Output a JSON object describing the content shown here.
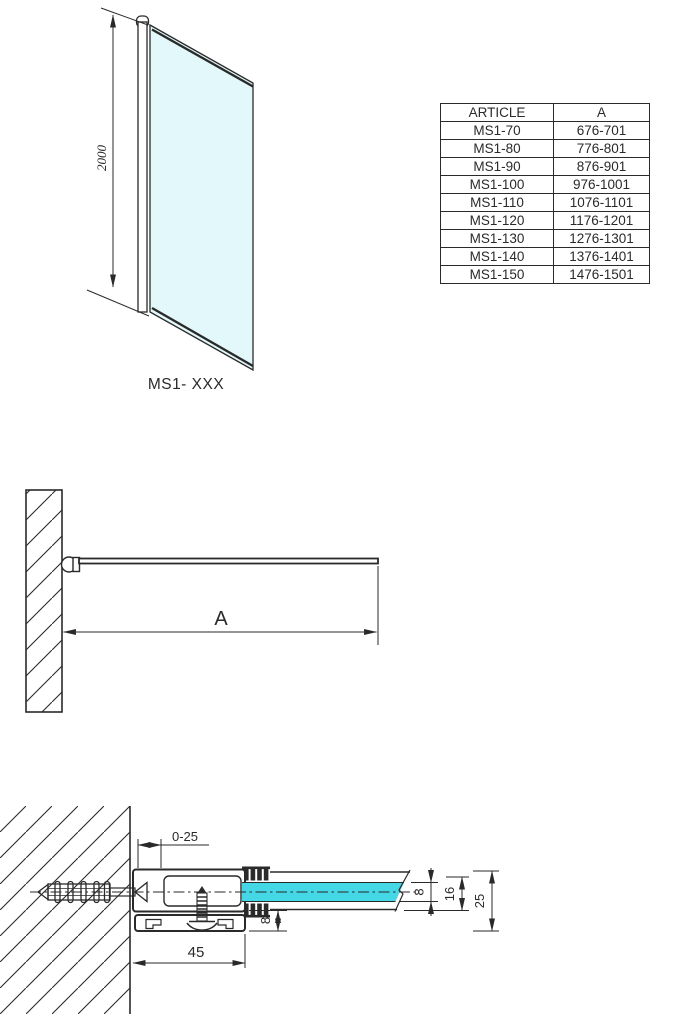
{
  "colors": {
    "line": "#2a2a2a",
    "glass_light": "#e2f8fa",
    "glass_bright": "#44d7e5",
    "background": "#ffffff"
  },
  "front_view": {
    "height_dimension": "2000",
    "model_label": "MS1- XXX"
  },
  "plan_view": {
    "width_dimension": "A"
  },
  "detail_view": {
    "wall_offset_dimension": "0-25",
    "profile_width_dimension": "45",
    "glass_thickness_dimension": "8",
    "bottom_profile_dimension": "8",
    "clamp_height_dimension": "16",
    "total_depth_dimension": "25"
  },
  "table": {
    "headers": [
      "ARTICLE",
      "A"
    ],
    "rows": [
      [
        "MS1-70",
        "676-701"
      ],
      [
        "MS1-80",
        "776-801"
      ],
      [
        "MS1-90",
        "876-901"
      ],
      [
        "MS1-100",
        "976-1001"
      ],
      [
        "MS1-110",
        "1076-1101"
      ],
      [
        "MS1-120",
        "1176-1201"
      ],
      [
        "MS1-130",
        "1276-1301"
      ],
      [
        "MS1-140",
        "1376-1401"
      ],
      [
        "MS1-150",
        "1476-1501"
      ]
    ]
  }
}
